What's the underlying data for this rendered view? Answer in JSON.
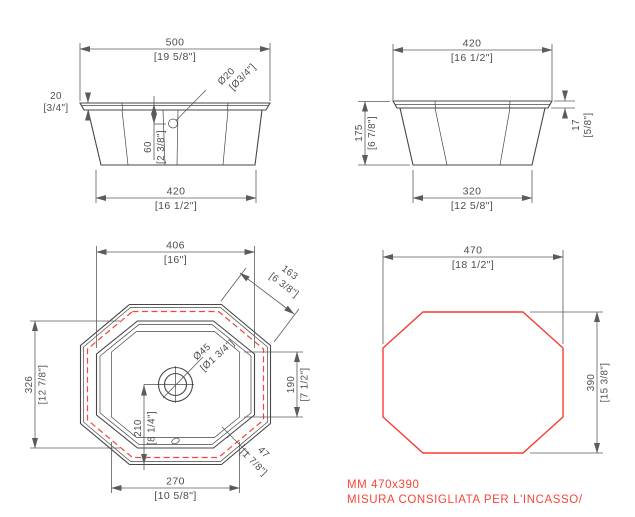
{
  "front_view": {
    "overall_width": {
      "mm": "500",
      "in": "[19 5/8\"]"
    },
    "rim_thickness": {
      "mm": "20",
      "in": "[3/4\"]"
    },
    "overflow_hole": {
      "mm": "Ø20",
      "in": "[Ø3/4\"]"
    },
    "overflow_depth": {
      "mm": "60",
      "in": "[2 3/8\"]"
    },
    "base_width": {
      "mm": "420",
      "in": "[16 1/2\"]"
    }
  },
  "side_view": {
    "overall_width": {
      "mm": "420",
      "in": "[16 1/2\"]"
    },
    "height": {
      "mm": "175",
      "in": "[6 7/8\"]"
    },
    "rim_thickness": {
      "mm": "17",
      "in": "[5/8\"]"
    },
    "base_width": {
      "mm": "320",
      "in": "[12 5/8\"]"
    }
  },
  "top_view": {
    "body_width": {
      "mm": "406",
      "in": "[16\"]"
    },
    "corner_facet": {
      "mm": "163",
      "in": "[6 3/8\"]"
    },
    "drain_diameter": {
      "mm": "Ø45",
      "in": "[Ø1 3/4\"]"
    },
    "inner_side_span": {
      "mm": "190",
      "in": "[7 1/2\"]"
    },
    "body_depth": {
      "mm": "326",
      "in": "[12 7/8\"]"
    },
    "drain_offset": {
      "mm": "210",
      "in": "[8 1/4\"]"
    },
    "rim_overhang": {
      "mm": "47",
      "in": "[1 7/8\"]"
    },
    "bottom_width": {
      "mm": "270",
      "in": "[10 5/8\"]"
    }
  },
  "cutout_view": {
    "width": {
      "mm": "470",
      "in": "[18 1/2\"]"
    },
    "height": {
      "mm": "390",
      "in": "[15 3/8\"]"
    }
  },
  "note": {
    "line1": "MM 470x390",
    "line2": "MISURA CONSIGLIATA PER L'INCASSO/"
  },
  "colors": {
    "line": "#474747",
    "cutout_red": "#f93b31"
  }
}
